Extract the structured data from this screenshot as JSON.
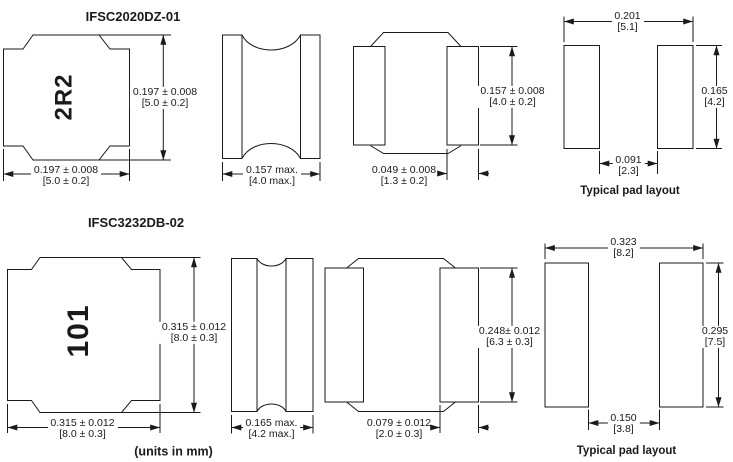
{
  "note_units": "(units in mm)",
  "parts": [
    {
      "title": "IFSC2020DZ-01",
      "marking": "2R2",
      "pad_label": "Typical pad layout",
      "dims": {
        "top_height_in": "0.197 ± 0.008",
        "top_height_mm": "[5.0 ± 0.2]",
        "top_width_in": "0.197 ± 0.008",
        "top_width_mm": "[5.0 ± 0.2]",
        "side_width_in": "0.157 max.",
        "side_width_mm": "[4.0 max.]",
        "terminal_in": "0.049 ± 0.008",
        "terminal_mm": "[1.3 ± 0.2]",
        "front_height_in": "0.157 ± 0.008",
        "front_height_mm": "[4.0 ± 0.2]",
        "pad_span_in": "0.201",
        "pad_span_mm": "[5.1]",
        "pad_height_in": "0.165",
        "pad_height_mm": "[4.2]",
        "pad_gap_in": "0.091",
        "pad_gap_mm": "[2.3]"
      }
    },
    {
      "title": "IFSC3232DB-02",
      "marking": "101",
      "pad_label": "Typical pad layout",
      "dims": {
        "top_height_in": "0.315 ± 0.012",
        "top_height_mm": "[8.0 ± 0.3]",
        "top_width_in": "0.315 ± 0.012",
        "top_width_mm": "[8.0 ± 0.3]",
        "side_width_in": "0.165 max.",
        "side_width_mm": "[4.2 max.]",
        "terminal_in": "0.079 ± 0.012",
        "terminal_mm": "[2.0 ± 0.3]",
        "front_height_in": "0.248± 0.012",
        "front_height_mm": "[6.3 ± 0.3]",
        "pad_span_in": "0.323",
        "pad_span_mm": "[8.2]",
        "pad_height_in": "0.295",
        "pad_height_mm": "[7.5]",
        "pad_gap_in": "0.150",
        "pad_gap_mm": "[3.8]"
      }
    }
  ]
}
